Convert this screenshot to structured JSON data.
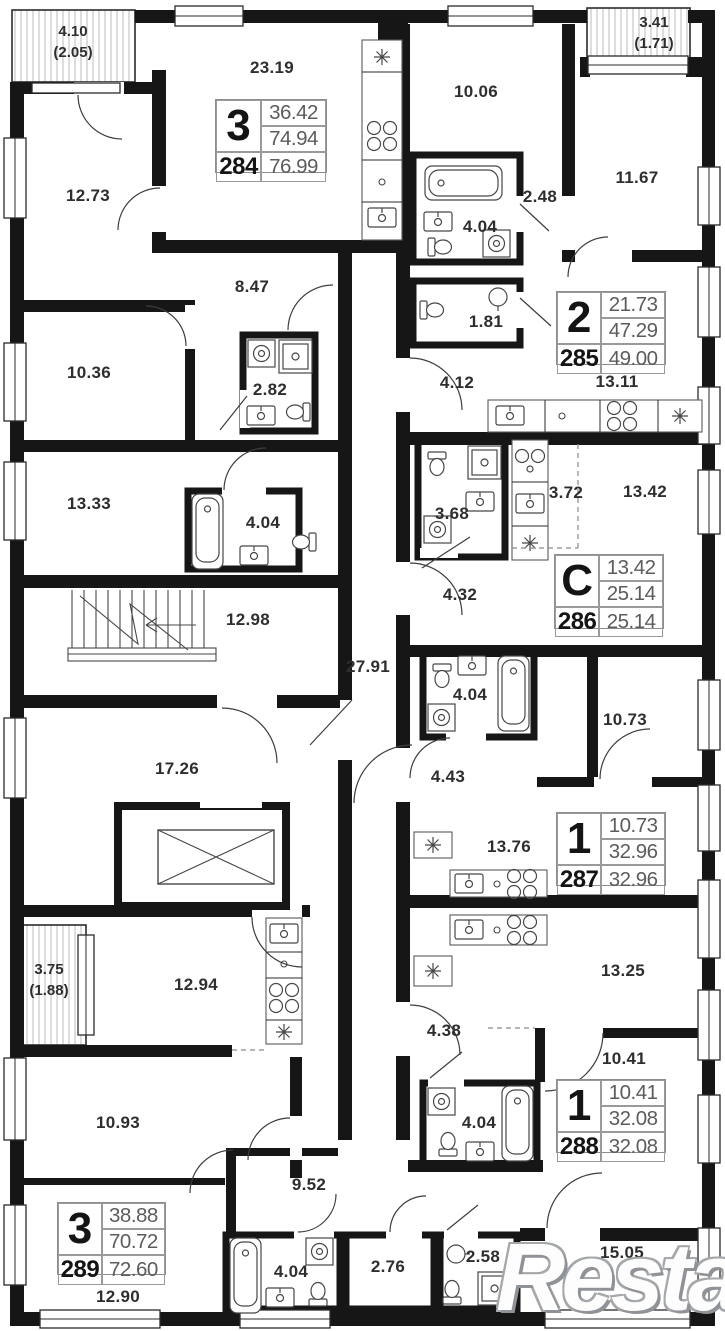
{
  "watermark": "Restate",
  "balconies": [
    {
      "area": "4.10",
      "reduced": "(2.05)"
    },
    {
      "area": "3.41",
      "reduced": "(1.71)"
    },
    {
      "area": "3.75",
      "reduced": "(1.88)"
    }
  ],
  "apartments": [
    {
      "number": "284",
      "rooms": "3",
      "living": "36.42",
      "area": "74.94",
      "total": "76.99"
    },
    {
      "number": "285",
      "rooms": "2",
      "living": "21.73",
      "area": "47.29",
      "total": "49.00"
    },
    {
      "number": "286",
      "rooms": "С",
      "living": "13.42",
      "area": "25.14",
      "total": "25.14"
    },
    {
      "number": "287",
      "rooms": "1",
      "living": "10.73",
      "area": "32.96",
      "total": "32.96"
    },
    {
      "number": "288",
      "rooms": "1",
      "living": "10.41",
      "area": "32.08",
      "total": "32.08"
    },
    {
      "number": "289",
      "rooms": "3",
      "living": "38.88",
      "area": "70.72",
      "total": "72.60"
    }
  ],
  "room_labels": [
    {
      "label": "23.19"
    },
    {
      "label": "12.73"
    },
    {
      "label": "10.06"
    },
    {
      "label": "11.67"
    },
    {
      "label": "2.48"
    },
    {
      "label": "4.04"
    },
    {
      "label": "1.81"
    },
    {
      "label": "4.12"
    },
    {
      "label": "13.11"
    },
    {
      "label": "8.47"
    },
    {
      "label": "10.36"
    },
    {
      "label": "2.82"
    },
    {
      "label": "13.33"
    },
    {
      "label": "4.04"
    },
    {
      "label": "12.98"
    },
    {
      "label": "27.91"
    },
    {
      "label": "3.68"
    },
    {
      "label": "3.72"
    },
    {
      "label": "13.42"
    },
    {
      "label": "4.32"
    },
    {
      "label": "4.04"
    },
    {
      "label": "10.73"
    },
    {
      "label": "4.43"
    },
    {
      "label": "13.76"
    },
    {
      "label": "17.26"
    },
    {
      "label": "12.94"
    },
    {
      "label": "10.93"
    },
    {
      "label": "13.25"
    },
    {
      "label": "4.38"
    },
    {
      "label": "10.41"
    },
    {
      "label": "4.04"
    },
    {
      "label": "9.52"
    },
    {
      "label": "12.90"
    },
    {
      "label": "4.04"
    },
    {
      "label": "2.76"
    },
    {
      "label": "2.58"
    },
    {
      "label": "15.05"
    }
  ]
}
